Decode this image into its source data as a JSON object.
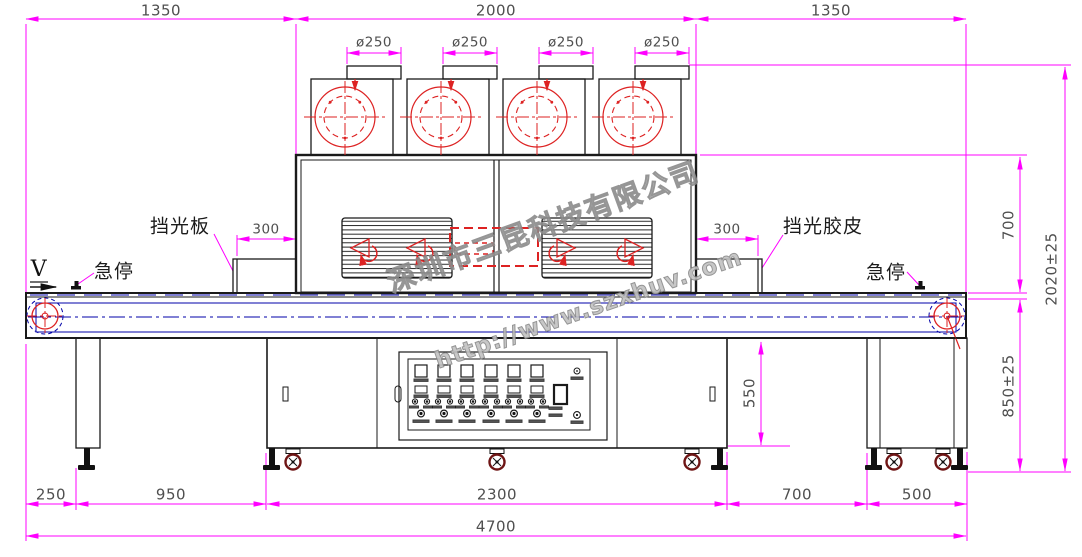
{
  "watermark": {
    "company": "深圳市三昆科技有限公司",
    "url": "http://www.szxhuv.com"
  },
  "labels": {
    "direction": "V",
    "shield_plate": "挡光板",
    "shield_rubber": "挡光胶皮",
    "estop_left": "急停",
    "estop_right": "急停"
  },
  "dims": {
    "top": [
      "1350",
      "2000",
      "1350"
    ],
    "fans": [
      "ø250",
      "ø250",
      "ø250",
      "ø250"
    ],
    "shield_left": "300",
    "shield_right": "300",
    "oven_height": "700",
    "total_height": "2020±25",
    "belt_height": "850±25",
    "cabinet_height": "550",
    "bottom": [
      "250",
      "950",
      "2300",
      "700",
      "500"
    ],
    "total_length": "4700"
  },
  "colors": {
    "dimension": "#ff00ff",
    "red": "#dd2222",
    "blue": "#0000a8",
    "line": "#1a1a1a",
    "caster": "#6e1414"
  }
}
